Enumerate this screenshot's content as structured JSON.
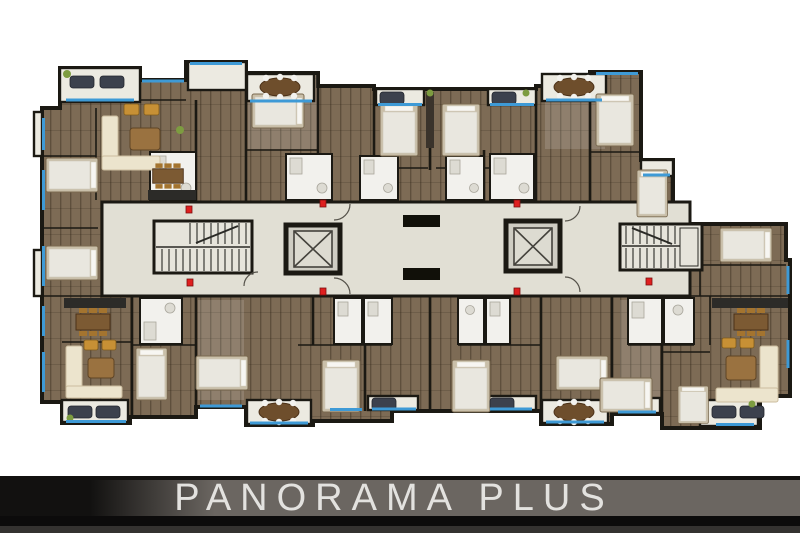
{
  "banner": {
    "title": "PANORAMA PLUS"
  },
  "plan": {
    "kind": "residential-typical-floor-plan",
    "features": {
      "elevators": 2,
      "stairwells": 2,
      "service_shafts": 2,
      "safety_markers": 7,
      "balconies": 11,
      "bathrooms": 11,
      "beds": 15
    }
  },
  "colors": {
    "paper": "#ffffff",
    "wall": "#1b1913",
    "wood": "#7d6b55",
    "wood-light": "#a08b6d",
    "corridor": "#e1dfd4",
    "balcony": "#eceae1",
    "bath": "#f2f1ed",
    "window-blue": "#3e9ad6",
    "marker-red": "#df1f1f",
    "sofa-dark": "#3c414d",
    "sofa-cream": "#ece4cd",
    "table-wood": "#9a7240",
    "gold": "#c79035",
    "counter": "#2c2b28",
    "plant": "#7d9c40",
    "band-gray": "#6b6661",
    "band-dark": "#121110",
    "band-text": "#e3e2df"
  }
}
